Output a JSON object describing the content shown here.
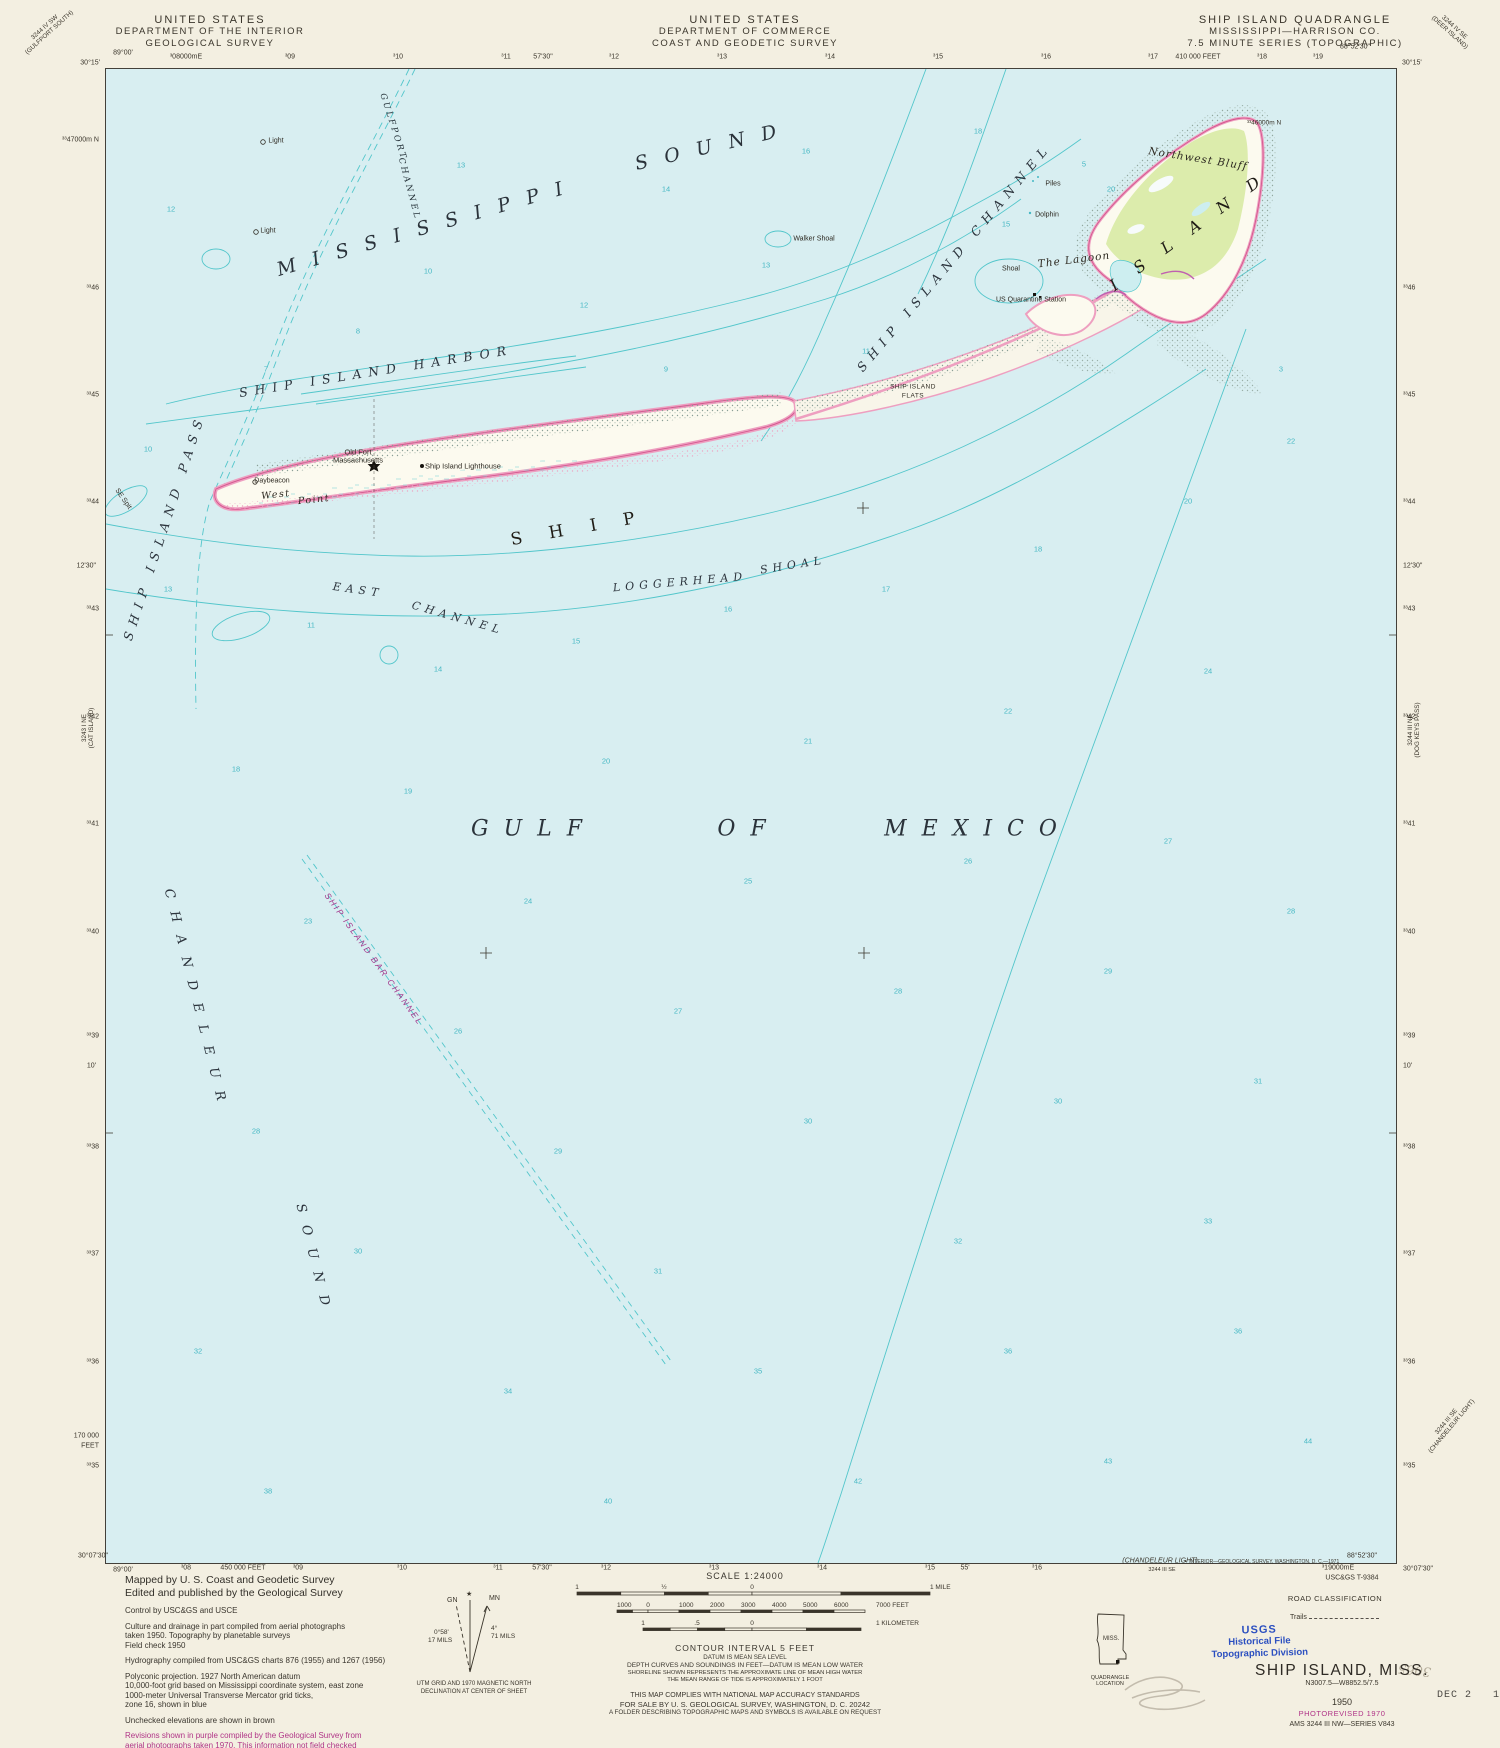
{
  "header": {
    "left": [
      "UNITED STATES",
      "DEPARTMENT OF THE INTERIOR",
      "GEOLOGICAL SURVEY"
    ],
    "center": [
      "UNITED STATES",
      "DEPARTMENT OF COMMERCE",
      "COAST AND GEODETIC SURVEY"
    ],
    "right": [
      "SHIP ISLAND QUADRANGLE",
      "MISSISSIPPI—HARRISON CO.",
      "7.5 MINUTE SERIES (TOPOGRAPHIC)"
    ]
  },
  "corner_diagonals": [
    {
      "x": 47,
      "y": 30,
      "r": -42,
      "lines": [
        "3244 IV SW",
        "(GULFPORT SOUTH)"
      ]
    },
    {
      "x": 1452,
      "y": 30,
      "r": 42,
      "lines": [
        "3244 IV SE",
        "(DEER ISLAND)"
      ]
    },
    {
      "x": 88,
      "y": 728,
      "r": -90,
      "lines": [
        "3243 I NE",
        "(CAT ISLAND)"
      ]
    },
    {
      "x": 1414,
      "y": 730,
      "r": -90,
      "lines": [
        "3244 III NE",
        "(DOG KEYS PASS)"
      ]
    },
    {
      "x": 1449,
      "y": 1424,
      "r": -50,
      "lines": [
        "3244 III SE",
        "(CHANDELEUR LIGHT)"
      ]
    }
  ],
  "edges": [
    {
      "x": 123,
      "y": 53,
      "a": "ac",
      "t": "89°00'"
    },
    {
      "x": 100,
      "y": 63,
      "a": "ar",
      "t": "30°15'"
    },
    {
      "x": 186,
      "y": 57,
      "a": "ac",
      "t": "³08000mE"
    },
    {
      "x": 290,
      "y": 57,
      "a": "ac",
      "t": "³09"
    },
    {
      "x": 398,
      "y": 57,
      "a": "ac",
      "t": "³10"
    },
    {
      "x": 506,
      "y": 57,
      "a": "ac",
      "t": "³11"
    },
    {
      "x": 543,
      "y": 57,
      "a": "ac",
      "t": "57'30\""
    },
    {
      "x": 614,
      "y": 57,
      "a": "ac",
      "t": "³12"
    },
    {
      "x": 722,
      "y": 57,
      "a": "ac",
      "t": "³13"
    },
    {
      "x": 830,
      "y": 57,
      "a": "ac",
      "t": "³14"
    },
    {
      "x": 938,
      "y": 57,
      "a": "ac",
      "t": "³15"
    },
    {
      "x": 1046,
      "y": 57,
      "a": "ac",
      "t": "³16"
    },
    {
      "x": 1153,
      "y": 57,
      "a": "ac",
      "t": "³17"
    },
    {
      "x": 1198,
      "y": 57,
      "a": "ac",
      "t": "410 000 FEET"
    },
    {
      "x": 1262,
      "y": 57,
      "a": "ac",
      "t": "³18"
    },
    {
      "x": 1318,
      "y": 57,
      "a": "ac",
      "t": "³19"
    },
    {
      "x": 1355,
      "y": 47,
      "a": "ac",
      "t": "88°52'30\""
    },
    {
      "x": 1402,
      "y": 63,
      "a": "al",
      "t": "30°15'"
    },
    {
      "x": 99,
      "y": 140,
      "a": "ar",
      "t": "³³47000m N"
    },
    {
      "x": 99,
      "y": 288,
      "a": "ar",
      "t": "³³46"
    },
    {
      "x": 99,
      "y": 395,
      "a": "ar",
      "t": "³³45"
    },
    {
      "x": 99,
      "y": 502,
      "a": "ar",
      "t": "³³44"
    },
    {
      "x": 96,
      "y": 566,
      "a": "ar",
      "t": "12'30\""
    },
    {
      "x": 99,
      "y": 609,
      "a": "ar",
      "t": "³³43"
    },
    {
      "x": 99,
      "y": 717,
      "a": "ar",
      "t": "³³42"
    },
    {
      "x": 99,
      "y": 824,
      "a": "ar",
      "t": "³³41"
    },
    {
      "x": 99,
      "y": 932,
      "a": "ar",
      "t": "³³40"
    },
    {
      "x": 99,
      "y": 1036,
      "a": "ar",
      "t": "³³39"
    },
    {
      "x": 96,
      "y": 1066,
      "a": "ar",
      "t": "10'"
    },
    {
      "x": 99,
      "y": 1147,
      "a": "ar",
      "t": "³³38"
    },
    {
      "x": 99,
      "y": 1254,
      "a": "ar",
      "t": "³³37"
    },
    {
      "x": 99,
      "y": 1362,
      "a": "ar",
      "t": "³³36"
    },
    {
      "x": 99,
      "y": 1436,
      "a": "ar",
      "t": "170 000"
    },
    {
      "x": 99,
      "y": 1446,
      "a": "ar",
      "t": "FEET"
    },
    {
      "x": 99,
      "y": 1466,
      "a": "ar",
      "t": "³³35"
    },
    {
      "x": 1403,
      "y": 288,
      "a": "al",
      "t": "³³46"
    },
    {
      "x": 1403,
      "y": 395,
      "a": "al",
      "t": "³³45"
    },
    {
      "x": 1403,
      "y": 502,
      "a": "al",
      "t": "³³44"
    },
    {
      "x": 1403,
      "y": 566,
      "a": "al",
      "t": "12'30\""
    },
    {
      "x": 1403,
      "y": 609,
      "a": "al",
      "t": "³³43"
    },
    {
      "x": 1403,
      "y": 717,
      "a": "al",
      "t": "³³42"
    },
    {
      "x": 1403,
      "y": 824,
      "a": "al",
      "t": "³³41"
    },
    {
      "x": 1403,
      "y": 932,
      "a": "al",
      "t": "³³40"
    },
    {
      "x": 1403,
      "y": 1036,
      "a": "al",
      "t": "³³39"
    },
    {
      "x": 1403,
      "y": 1066,
      "a": "al",
      "t": "10'"
    },
    {
      "x": 1403,
      "y": 1147,
      "a": "al",
      "t": "³³38"
    },
    {
      "x": 1403,
      "y": 1254,
      "a": "al",
      "t": "³³37"
    },
    {
      "x": 1403,
      "y": 1362,
      "a": "al",
      "t": "³³36"
    },
    {
      "x": 1403,
      "y": 1466,
      "a": "al",
      "t": "³³35"
    },
    {
      "x": 108,
      "y": 1556,
      "a": "ar",
      "t": "30°07'30\""
    },
    {
      "x": 123,
      "y": 1570,
      "a": "ac",
      "t": "89°00'"
    },
    {
      "x": 186,
      "y": 1568,
      "a": "ac",
      "t": "³08"
    },
    {
      "x": 243,
      "y": 1568,
      "a": "ac",
      "t": "450 000 FEET"
    },
    {
      "x": 298,
      "y": 1568,
      "a": "ac",
      "t": "³09"
    },
    {
      "x": 402,
      "y": 1568,
      "a": "ac",
      "t": "³10"
    },
    {
      "x": 498,
      "y": 1568,
      "a": "ac",
      "t": "³11"
    },
    {
      "x": 542,
      "y": 1568,
      "a": "ac",
      "t": "57'30\""
    },
    {
      "x": 606,
      "y": 1568,
      "a": "ac",
      "t": "³12"
    },
    {
      "x": 714,
      "y": 1568,
      "a": "ac",
      "t": "³13"
    },
    {
      "x": 822,
      "y": 1568,
      "a": "ac",
      "t": "³14"
    },
    {
      "x": 930,
      "y": 1568,
      "a": "ac",
      "t": "³15"
    },
    {
      "x": 965,
      "y": 1568,
      "a": "ac",
      "t": "55'"
    },
    {
      "x": 1037,
      "y": 1568,
      "a": "ac",
      "t": "³16"
    },
    {
      "x": 1338,
      "y": 1568,
      "a": "ac",
      "t": "³19000mE"
    },
    {
      "x": 1362,
      "y": 1556,
      "a": "ac",
      "t": "88°52'30\""
    },
    {
      "x": 1403,
      "y": 1569,
      "a": "al",
      "t": "30°07'30\""
    }
  ],
  "bottom_margin": {
    "chandeleur1": "(CHANDELEUR LIGHT)",
    "chandeleur2": "3244 III SE",
    "interior_credit": "•  INTERIOR—GEOLOGICAL SURVEY, WASHINGTON, D. C.—1971",
    "tsheet": "USC&GS T-9384"
  },
  "map_labels": [
    {
      "t": "GULFPORT",
      "x": 287,
      "y": 58,
      "r": 72,
      "c": "chan"
    },
    {
      "t": "CHANNEL",
      "x": 303,
      "y": 120,
      "r": 75,
      "c": "chan"
    },
    {
      "t": "MISSISSIPPI",
      "x": 322,
      "y": 158,
      "r": -16,
      "c": "sound"
    },
    {
      "t": "SOUND",
      "x": 608,
      "y": 77,
      "r": -13,
      "c": "sound"
    },
    {
      "t": "Light",
      "x": 170,
      "y": 72,
      "r": 0,
      "c": "xs"
    },
    {
      "t": "Light",
      "x": 162,
      "y": 162,
      "r": 0,
      "c": "xs"
    },
    {
      "t": "Walker Shoal",
      "x": 708,
      "y": 170,
      "r": 0,
      "c": "xs"
    },
    {
      "t": "SHIP ISLAND CHANNEL",
      "x": 848,
      "y": 188,
      "r": -50,
      "c": "water2"
    },
    {
      "t": "Piles",
      "x": 947,
      "y": 115,
      "r": 0,
      "c": "xs"
    },
    {
      "t": "Dolphin",
      "x": 941,
      "y": 146,
      "r": 0,
      "c": "xs"
    },
    {
      "t": "Northwest Bluff",
      "x": 1092,
      "y": 90,
      "r": 9,
      "c": "pit"
    },
    {
      "t": "The Lagoon",
      "x": 968,
      "y": 191,
      "r": -7,
      "c": "pit"
    },
    {
      "t": "ISLAND",
      "x": 1088,
      "y": 158,
      "r": -36,
      "c": "big2"
    },
    {
      "t": "Shoal",
      "x": 905,
      "y": 200,
      "r": 0,
      "c": "xs"
    },
    {
      "t": "US Quarantine Station",
      "x": 925,
      "y": 231,
      "r": 0,
      "c": "xs"
    },
    {
      "t": "SHIP ISLAND",
      "x": 807,
      "y": 318,
      "r": 0,
      "c": "xxs"
    },
    {
      "t": "FLATS",
      "x": 807,
      "y": 327,
      "r": 0,
      "c": "xxs"
    },
    {
      "t": "SHIP ISLAND HARBOR",
      "x": 270,
      "y": 302,
      "r": -9,
      "c": "water2"
    },
    {
      "t": "SHIP",
      "x": 480,
      "y": 458,
      "r": -10,
      "c": "big"
    },
    {
      "t": "Old Fort",
      "x": 252,
      "y": 383,
      "r": 0,
      "c": "sm"
    },
    {
      "t": "Massachusetts",
      "x": 252,
      "y": 391,
      "r": 0,
      "c": "sm"
    },
    {
      "t": "Ship Island Lighthouse",
      "x": 357,
      "y": 397,
      "r": 0,
      "c": "sm"
    },
    {
      "t": "Daybeacon",
      "x": 166,
      "y": 412,
      "r": 0,
      "c": "xs"
    },
    {
      "t": "West",
      "x": 170,
      "y": 426,
      "r": -6,
      "c": "pitsm"
    },
    {
      "t": "Point",
      "x": 208,
      "y": 431,
      "r": -6,
      "c": "pitsm"
    },
    {
      "t": "SE Spit",
      "x": 17,
      "y": 430,
      "r": 55,
      "c": "xs"
    },
    {
      "t": "SHIP ISLAND PASS",
      "x": 58,
      "y": 458,
      "r": -72,
      "c": "water2"
    },
    {
      "t": "EAST",
      "x": 252,
      "y": 521,
      "r": 8,
      "c": "water3"
    },
    {
      "t": "CHANNEL",
      "x": 352,
      "y": 549,
      "r": 16,
      "c": "water3"
    },
    {
      "t": "LOGGERHEAD",
      "x": 574,
      "y": 513,
      "r": -5,
      "c": "water3"
    },
    {
      "t": "SHOAL",
      "x": 687,
      "y": 496,
      "r": -9,
      "c": "water3"
    },
    {
      "t": "GULF",
      "x": 428,
      "y": 760,
      "r": 0,
      "c": "gulf"
    },
    {
      "t": "OF",
      "x": 643,
      "y": 760,
      "r": 0,
      "c": "gulf"
    },
    {
      "t": "MEXICO",
      "x": 872,
      "y": 760,
      "r": 0,
      "c": "gulf"
    },
    {
      "t": "CHANDELEUR",
      "x": 90,
      "y": 932,
      "r": 76,
      "c": "water2b"
    },
    {
      "t": "SOUND",
      "x": 208,
      "y": 1192,
      "r": 76,
      "c": "water2b"
    },
    {
      "t": "SHIP ISLAND BAR CHANNEL",
      "x": 268,
      "y": 890,
      "r": 54,
      "c": "purp"
    },
    {
      "t": "³³46000m N",
      "x": 1158,
      "y": 54,
      "r": 0,
      "c": "edgein"
    }
  ],
  "soundings": [
    {
      "x": 65,
      "y": 140,
      "v": "12"
    },
    {
      "x": 355,
      "y": 96,
      "v": "13"
    },
    {
      "x": 560,
      "y": 120,
      "v": "14"
    },
    {
      "x": 700,
      "y": 82,
      "v": "16"
    },
    {
      "x": 872,
      "y": 62,
      "v": "18"
    },
    {
      "x": 322,
      "y": 202,
      "v": "10"
    },
    {
      "x": 478,
      "y": 236,
      "v": "12"
    },
    {
      "x": 660,
      "y": 196,
      "v": "13"
    },
    {
      "x": 252,
      "y": 262,
      "v": "8"
    },
    {
      "x": 160,
      "y": 300,
      "v": "7"
    },
    {
      "x": 560,
      "y": 300,
      "v": "9"
    },
    {
      "x": 760,
      "y": 282,
      "v": "11"
    },
    {
      "x": 900,
      "y": 155,
      "v": "15"
    },
    {
      "x": 1005,
      "y": 120,
      "v": "20"
    },
    {
      "x": 1175,
      "y": 300,
      "v": "3"
    },
    {
      "x": 978,
      "y": 95,
      "v": "5"
    },
    {
      "x": 42,
      "y": 380,
      "v": "10"
    },
    {
      "x": 62,
      "y": 520,
      "v": "13"
    },
    {
      "x": 205,
      "y": 556,
      "v": "11"
    },
    {
      "x": 332,
      "y": 600,
      "v": "14"
    },
    {
      "x": 470,
      "y": 572,
      "v": "15"
    },
    {
      "x": 622,
      "y": 540,
      "v": "16"
    },
    {
      "x": 780,
      "y": 520,
      "v": "17"
    },
    {
      "x": 932,
      "y": 480,
      "v": "18"
    },
    {
      "x": 1082,
      "y": 432,
      "v": "20"
    },
    {
      "x": 1185,
      "y": 372,
      "v": "22"
    },
    {
      "x": 130,
      "y": 700,
      "v": "18"
    },
    {
      "x": 302,
      "y": 722,
      "v": "19"
    },
    {
      "x": 500,
      "y": 692,
      "v": "20"
    },
    {
      "x": 702,
      "y": 672,
      "v": "21"
    },
    {
      "x": 902,
      "y": 642,
      "v": "22"
    },
    {
      "x": 1102,
      "y": 602,
      "v": "24"
    },
    {
      "x": 202,
      "y": 852,
      "v": "23"
    },
    {
      "x": 422,
      "y": 832,
      "v": "24"
    },
    {
      "x": 642,
      "y": 812,
      "v": "25"
    },
    {
      "x": 862,
      "y": 792,
      "v": "26"
    },
    {
      "x": 1062,
      "y": 772,
      "v": "27"
    },
    {
      "x": 1185,
      "y": 842,
      "v": "28"
    },
    {
      "x": 352,
      "y": 962,
      "v": "26"
    },
    {
      "x": 572,
      "y": 942,
      "v": "27"
    },
    {
      "x": 792,
      "y": 922,
      "v": "28"
    },
    {
      "x": 1002,
      "y": 902,
      "v": "29"
    },
    {
      "x": 150,
      "y": 1062,
      "v": "28"
    },
    {
      "x": 452,
      "y": 1082,
      "v": "29"
    },
    {
      "x": 702,
      "y": 1052,
      "v": "30"
    },
    {
      "x": 952,
      "y": 1032,
      "v": "30"
    },
    {
      "x": 1152,
      "y": 1012,
      "v": "31"
    },
    {
      "x": 252,
      "y": 1182,
      "v": "30"
    },
    {
      "x": 552,
      "y": 1202,
      "v": "31"
    },
    {
      "x": 852,
      "y": 1172,
      "v": "32"
    },
    {
      "x": 1102,
      "y": 1152,
      "v": "33"
    },
    {
      "x": 92,
      "y": 1282,
      "v": "32"
    },
    {
      "x": 402,
      "y": 1322,
      "v": "34"
    },
    {
      "x": 652,
      "y": 1302,
      "v": "35"
    },
    {
      "x": 902,
      "y": 1282,
      "v": "36"
    },
    {
      "x": 1132,
      "y": 1262,
      "v": "36"
    },
    {
      "x": 162,
      "y": 1422,
      "v": "38"
    },
    {
      "x": 502,
      "y": 1432,
      "v": "40"
    },
    {
      "x": 752,
      "y": 1412,
      "v": "42"
    },
    {
      "x": 1002,
      "y": 1392,
      "v": "43"
    },
    {
      "x": 1202,
      "y": 1372,
      "v": "44"
    }
  ],
  "credits": {
    "big": [
      "Mapped by U. S. Coast and Geodetic Survey",
      "Edited and published by the Geological Survey"
    ],
    "small": [
      "Control by USC&GS and USCE",
      "",
      "Culture and drainage in part compiled from aerial photographs",
      "taken 1950.   Topography by planetable surveys",
      "Field check 1950",
      "",
      "Hydrography compiled from USC&GS charts 876 (1955) and 1267 (1956)",
      "",
      "Polyconic projection.   1927 North American datum",
      "10,000-foot grid based on Mississippi coordinate system, east zone",
      "1000-meter Universal Transverse Mercator grid ticks,",
      "zone 16, shown in blue",
      "",
      "Unchecked elevations are shown in brown"
    ],
    "purple": [
      "Revisions shown in purple compiled by the Geological Survey from",
      "aerial photographs taken 1970.  This information not field checked"
    ]
  },
  "declination": {
    "mn": "MN",
    "gn": "GN",
    "star": "★",
    "v1a": "0°58'",
    "v1b": "17 MILS",
    "v2a": "4°",
    "v2b": "71 MILS",
    "caption1": "UTM GRID AND 1970 MAGNETIC NORTH",
    "caption2": "DECLINATION AT CENTER OF SHEET"
  },
  "scale": {
    "title": "SCALE 1:24000",
    "mile_labels": [
      {
        "x": 77,
        "t": "1"
      },
      {
        "x": 164,
        "t": "½"
      },
      {
        "x": 252,
        "t": "0"
      },
      {
        "x": 430,
        "t": "1 MILE"
      }
    ],
    "feet_labels": [
      {
        "x": 117,
        "t": "1000"
      },
      {
        "x": 148,
        "t": "0"
      },
      {
        "x": 179,
        "t": "1000"
      },
      {
        "x": 210,
        "t": "2000"
      },
      {
        "x": 241,
        "t": "3000"
      },
      {
        "x": 272,
        "t": "4000"
      },
      {
        "x": 303,
        "t": "5000"
      },
      {
        "x": 334,
        "t": "6000"
      },
      {
        "x": 376,
        "t": "7000 FEET"
      }
    ],
    "km_labels": [
      {
        "x": 143,
        "t": "1"
      },
      {
        "x": 197,
        "t": ".5"
      },
      {
        "x": 252,
        "t": "0"
      },
      {
        "x": 376,
        "t": "1 KILOMETER"
      }
    ]
  },
  "notes": {
    "contour": "CONTOUR INTERVAL 5 FEET",
    "datum": "DATUM IS MEAN SEA LEVEL",
    "depth": "DEPTH CURVES AND SOUNDINGS IN FEET—DATUM IS MEAN LOW WATER",
    "shoreline": "SHORELINE SHOWN REPRESENTS THE APPROXIMATE LINE OF MEAN HIGH WATER",
    "tide": "THE MEAN RANGE OF TIDE IS APPROXIMATELY 1 FOOT",
    "accuracy": "THIS MAP COMPLIES WITH NATIONAL MAP ACCURACY STANDARDS",
    "sale": "FOR SALE BY U. S. GEOLOGICAL SURVEY, WASHINGTON, D. C. 20242",
    "folder": "A FOLDER DESCRIBING TOPOGRAPHIC MAPS AND SYMBOLS IS AVAILABLE ON REQUEST"
  },
  "location_inset": {
    "state": "MISS.",
    "caption": "QUADRANGLE LOCATION"
  },
  "stamp": {
    "l1": "USGS",
    "l2": "Historical File",
    "l3": "Topographic Division"
  },
  "road_class": {
    "title": "ROAD CLASSIFICATION",
    "trails": "Trails"
  },
  "title_block": {
    "name": "SHIP ISLAND, MISS.",
    "coords": "N3007.5—W8852.5/7.5",
    "year": "1950",
    "photorev": "PHOTOREVISED 1970",
    "ams": "AMS 3244 III NW—SERIES V843"
  },
  "date_stamp": "DEC 2   1971",
  "pencil_note": "3065",
  "colors": {
    "paper": "#f3efe1",
    "water": "#d8eef1",
    "contour": "#53c6cb",
    "sand": "#fcfaef",
    "beach_pink": "#ee9fc0",
    "shore_line": "#d4578f",
    "woodland": "#dcecac",
    "revision_purple": "#b03487",
    "stamp_blue": "#2b4fc0"
  }
}
